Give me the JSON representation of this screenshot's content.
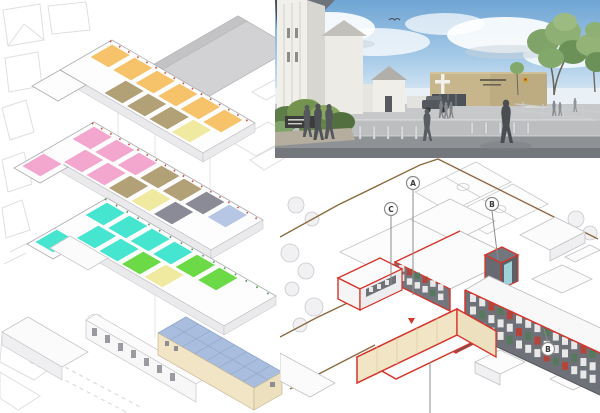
{
  "canvas": {
    "width": 600,
    "height": 413,
    "background": "#FFFFFF"
  },
  "callouts": {
    "a": "A",
    "c": "C",
    "b_upper": "B",
    "b_lower": "B"
  },
  "colors": {
    "accent_red": "#D5352B",
    "roof_gray": "#D2D2D4",
    "roof_gray_dark": "#C3C3C6",
    "context_line": "#DFDFE2",
    "slab_white": "#FDFDFD",
    "slab_edge": "#EAEAED",
    "facade_gray": "#6E7278",
    "facade_gray_light": "#73777D",
    "facade_gray_dark": "#5C6066",
    "cream": "#F1E5C6",
    "cream_shade": "#EDE0BE",
    "pool_roof_blue": "#A9BDDE",
    "pool_roof_line": "#8FA6C8",
    "boundary_brown": "#8A6B3F",
    "leader_gray": "#8C8C8C",
    "court_line": "#C9C9CD",
    "glass_cyan": "#9ED2DB",
    "room_orange": "#F6C26A",
    "room_tan": "#B2A077",
    "room_yellow": "#F0E9A0",
    "room_pink": "#F4A7CE",
    "room_gray": "#8B8B97",
    "room_pale_blue": "#B6C6E4",
    "room_cyan": "#45E5D0",
    "room_green": "#6CDA47",
    "sky_top": "#6FA5D4",
    "sky_mid": "#A9CCE8",
    "sky_horizon": "#EDF4FA",
    "cloud_white": "#FFFFFF",
    "pavement_light": "#C6C8CA",
    "pavement_mid": "#BCBEC0",
    "pavement_dark": "#8F9295",
    "pavement_deep": "#73767A",
    "church_white": "#F0EFEA",
    "church_shade": "#D8D6D1",
    "college_tan": "#C7B68B",
    "college_tan_dark": "#B9A87E",
    "foliage_dark": "#5E7C49",
    "foliage_mid": "#7FA368",
    "foliage_light": "#93B377",
    "person_dark": "#54575B",
    "window_frame": "#E8E8E8",
    "window_red": "#B5453B",
    "window_green": "#55795A"
  },
  "left_axo": {
    "floors": {
      "second": {
        "rows": [
          {
            "du": 30,
            "dv": 4,
            "colors": [
              "room_orange",
              "room_orange",
              "room_orange",
              "room_orange",
              "room_orange",
              "room_orange"
            ]
          },
          {
            "du": 2,
            "dv": 22,
            "colors": [
              null,
              "room_tan",
              "room_tan",
              "room_tan",
              "room_yellow"
            ]
          }
        ]
      },
      "first": {
        "rows": [
          {
            "du": 30,
            "dv": 4,
            "colors": [
              "room_pink",
              "room_pink",
              "room_pink",
              "room_tan",
              "room_tan",
              "room_gray",
              "room_pale_blue"
            ]
          },
          {
            "du": 2,
            "dv": 22,
            "colors": [
              "room_pink",
              "room_pink",
              "room_tan",
              "room_yellow",
              "room_gray"
            ]
          },
          {
            "du": -26,
            "dv": 2,
            "colors": [
              "room_pink"
            ]
          }
        ]
      },
      "ground": {
        "rows": [
          {
            "du": 30,
            "dv": 4,
            "colors": [
              "room_cyan",
              "room_cyan",
              "room_cyan",
              "room_cyan",
              "room_green",
              "room_green"
            ]
          },
          {
            "du": 2,
            "dv": 22,
            "colors": [
              "room_cyan",
              "room_cyan",
              "room_green",
              "room_yellow"
            ]
          },
          {
            "du": -26,
            "dv": 2,
            "colors": [
              "room_cyan"
            ]
          }
        ]
      }
    }
  },
  "proposed": {
    "window_pattern": [
      "window_frame",
      "window_frame",
      "window_red",
      "window_frame",
      "window_green",
      "window_frame",
      "window_red",
      "window_frame",
      "window_frame",
      "window_green"
    ],
    "long_facade": {
      "rows": 3,
      "cols": 14
    },
    "entrance_facade": {
      "rows": 2,
      "cols": 6
    }
  }
}
